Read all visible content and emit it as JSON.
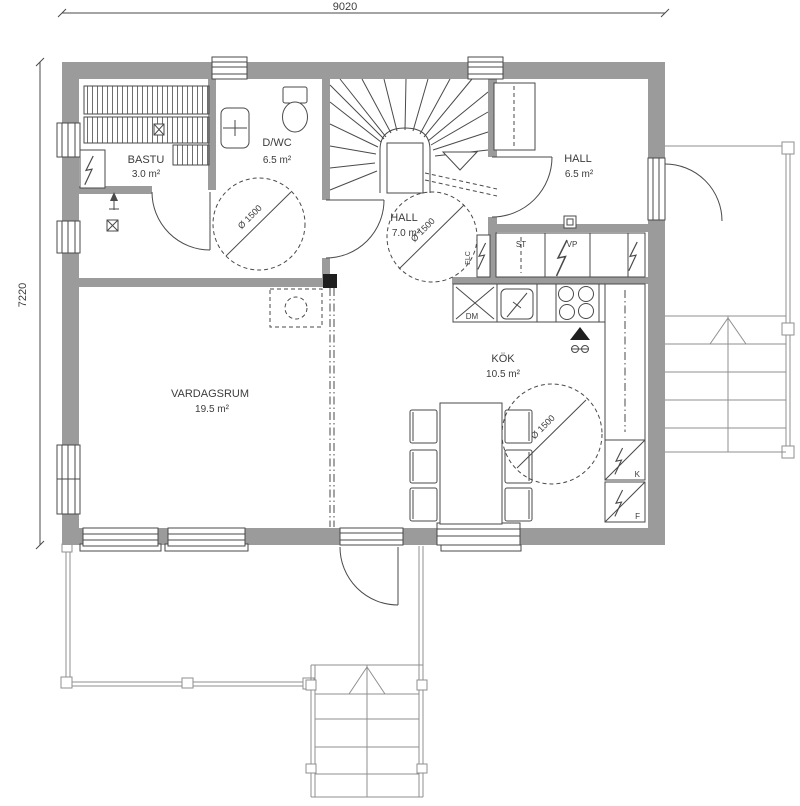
{
  "dimensions": {
    "width": "9020",
    "height": "7220"
  },
  "rooms": {
    "bastu": {
      "name": "BASTU",
      "area": "3.0 m²"
    },
    "dwc": {
      "name": "D/WC",
      "area": "6.5 m²"
    },
    "hall_inner": {
      "name": "HALL",
      "area": "7.0 m²"
    },
    "hall_entry": {
      "name": "HALL",
      "area": "6.5 m²"
    },
    "vardagsrum": {
      "name": "VARDAGSRUM",
      "area": "19.5 m²"
    },
    "kok": {
      "name": "KÖK",
      "area": "10.5 m²"
    }
  },
  "accessibility": {
    "turning_circle": "Ø 1500"
  },
  "appliances": {
    "dishwasher": "DM",
    "cleaning_closet": "ST",
    "heat_pump": "VP",
    "fridge": "K",
    "freezer": "F",
    "el_central": "ELC"
  },
  "colors": {
    "wall": "#9b9b9b",
    "line": "#4a4a4a",
    "thin": "#8f8f8f",
    "text": "#3c3c3c",
    "dark": "#1f1f1f",
    "bg": "#ffffff"
  }
}
